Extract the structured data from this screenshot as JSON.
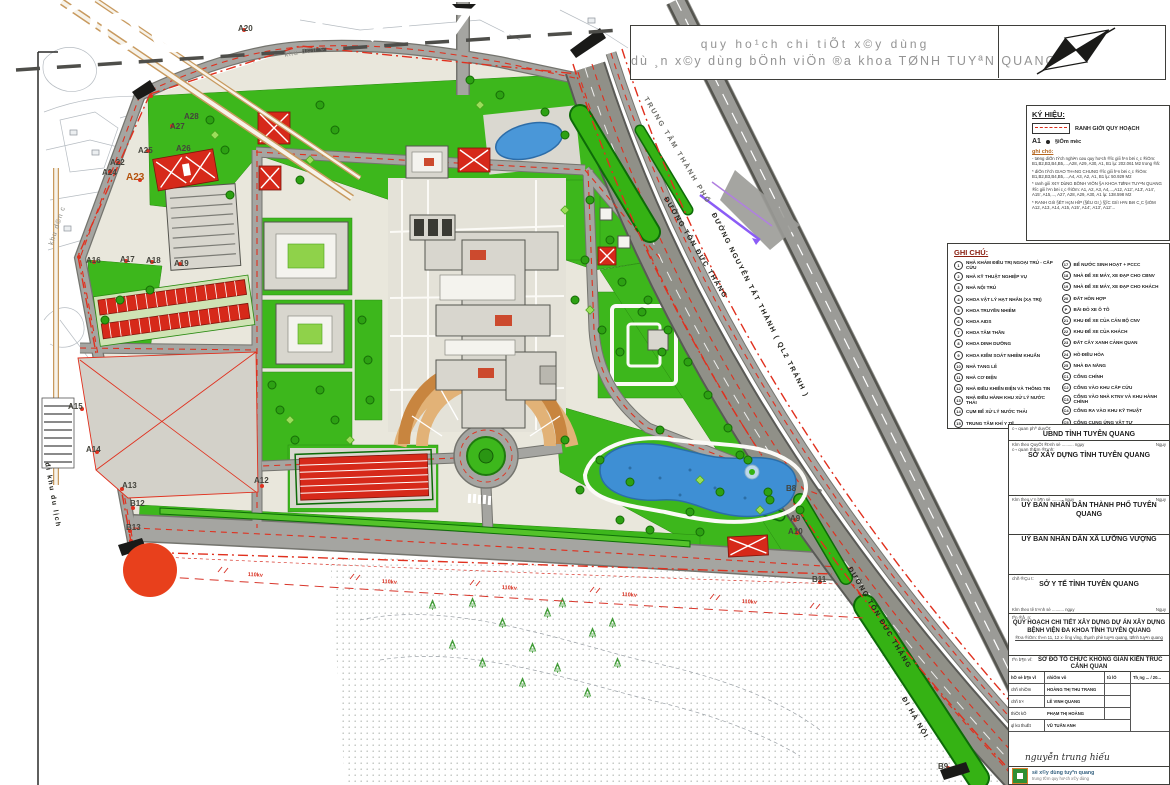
{
  "banner": {
    "line1": "quy ho¹ch chi tiÕt x©y dùng",
    "line2": "dù ¸n x©y dùng bÖnh viÖn ®a khoa TØNH TUYªN QUANG"
  },
  "legend": {
    "title": "KÝ HIỆU:",
    "boundary_label": "RANH GIỚI QUY HOẠCH",
    "marker_code": "A1",
    "marker_label": "§iÓm mèc",
    "notes_title": "ghi chó:",
    "notes": [
      "- tæng diÖn tÝch nghiªn cøu quy ho¹ch ®­îc giíi h¹n bëi c¸c ®iÓm: B1,B2,B3,B4,B5,...,A28, A29, A30, A1, B1 lµ: 202.061 M2 trong ®ã:",
      "* diÖn tÝch GIAO TH«NG CHUNG ®­îc giíi h¹n bëi c¸c ®iÓm: B1,B2,B3,B4,B5,...,A4, A3, A2, A1, B1 lµ: 50.929 M2",
      "* ranh giíi X¢Y DùNG BÖNH VIÖN §A KHOA TØNH TUYªN QUANG ®­îc giíi h¹n bëi c¸c ®iÓm: A1, A2, A3, A4,...,A12, A12', A13', A14', A15', A15,..., A27, A28, A29, A30, A1 lµ: 138.598 M2",
      "* RANH GIíI §ÊT HçN HîP (§ÊU GI¸) §¦îC GIíI H¹N BëI C¸C §IÓM A12, A13, A14, A15, A15', A14', A13', A12'..."
    ]
  },
  "notes_panel": {
    "title": "GHI CHÚ:",
    "items_left": [
      {
        "n": "1",
        "t": "NHÀ KHÁM ĐIỀU TRỊ NGOẠI TRÚ - CẤP CỨU"
      },
      {
        "n": "2",
        "t": "NHÀ KỸ THUẬT NGHIỆP VỤ"
      },
      {
        "n": "3",
        "t": "NHÀ NỘI TRÚ"
      },
      {
        "n": "4",
        "t": "KHOA VẬT LÝ HẠT NHÂN (XẠ TRỊ)"
      },
      {
        "n": "5",
        "t": "KHOA TRUYỀN NHIỄM"
      },
      {
        "n": "6",
        "t": "KHOA AIDS"
      },
      {
        "n": "7",
        "t": "KHOA TÂM THẦN"
      },
      {
        "n": "8",
        "t": "KHOA DINH DƯỠNG"
      },
      {
        "n": "9",
        "t": "KHOA KIỂM SOÁT NHIỄM KHUẨN"
      },
      {
        "n": "10",
        "t": "NHÀ TANG LỄ"
      },
      {
        "n": "11",
        "t": "NHÀ CƠ ĐIỆN"
      },
      {
        "n": "12",
        "t": "NHÀ ĐIỀU KHIỂN ĐIỆN VÀ THÔNG TIN"
      },
      {
        "n": "13",
        "t": "NHÀ ĐIỀU HÀNH KHU XỬ LÝ NƯỚC THẢI"
      },
      {
        "n": "14",
        "t": "CỤM BỂ XỬ LÝ NƯỚC THẢI"
      },
      {
        "n": "15",
        "t": "TRUNG TÂM KHÍ Y TẾ"
      },
      {
        "n": "16",
        "t": "NHÀ XỬ LÝ RÁC THẢI Y TẾ"
      }
    ],
    "items_right": [
      {
        "n": "17",
        "t": "BỂ NƯỚC SINH HOẠT + PCCC"
      },
      {
        "n": "18",
        "t": "NHÀ ĐỂ XE MÁY, XE ĐẠP CHO CBNV"
      },
      {
        "n": "19",
        "t": "NHÀ ĐỂ XE MÁY, XE ĐẠP CHO KHÁCH"
      },
      {
        "n": "20",
        "t": "ĐẤT HỖN HỢP"
      },
      {
        "n": "P",
        "t": "BÃI ĐỖ XE Ô TÔ"
      },
      {
        "n": "21",
        "t": "KHU ĐỂ XE CỦA CÁN BỘ CNV"
      },
      {
        "n": "22",
        "t": "KHU ĐỂ XE CỦA KHÁCH"
      },
      {
        "n": "23",
        "t": "ĐẤT CÂY XANH CẢNH QUAN"
      },
      {
        "n": "24",
        "t": "HỒ ĐIỀU HÒA"
      },
      {
        "n": "25",
        "t": "NHÀ ĐA NĂNG"
      },
      {
        "n": "C1",
        "t": "CỔNG CHÍNH"
      },
      {
        "n": "C2",
        "t": "CỔNG VÀO KHU CẤP CỨU"
      },
      {
        "n": "C3",
        "t": "CỔNG VÀO NHÀ KTNV VÀ KHU HÀNH CHÍNH"
      },
      {
        "n": "C4",
        "t": "CỔNG RA VÀO KHU KỸ THUẬT"
      },
      {
        "n": "C5",
        "t": "CỔNG CUNG ỨNG VẬT TƯ"
      },
      {
        "n": "C6",
        "t": "CỔNG THĂM KHÁM BỆNH NHÂN"
      }
    ]
  },
  "tb": {
    "approve_small": "c¬ quan phª duyÖt:",
    "approve_main": "UBND TỈNH TUYÊN QUANG",
    "agree_note": "KÌm theo QuyÕt ®Þnh sè .......... ngµy",
    "ngay": "Ngµy",
    "agree_small": "c¬ quan thÈm ®Þnh:",
    "agree_main": "SỞ XÂY DỰNG TỈNH TUYÊN QUANG",
    "city_note": "KÌm theo v¨n b¶n sè .......... ngµy",
    "city_main": "UỶ BAN NHÂN DÂN THÀNH PHỐ TUYÊN QUANG",
    "commune_main": "UỶ BAN NHÂN DÂN XÃ LƯỠNG VƯỢNG",
    "investor_small": "chñ ®Çu t­:",
    "investor_main": "SỞ Y TẾ TỈNH TUYÊN QUANG",
    "investor_note": "KÌm theo tê tr×nh sè .......... ngµy",
    "project_small": "tªn ®å ¸n:",
    "project_main": "QUY HOẠCH CHI TIẾT XÂY DỰNG DỰ ÁN XÂY DỰNG BỆNH VIỆN ĐA KHOA TỈNH TUYÊN QUANG",
    "project_location": "®Þa ®iÓm: th«n 11, 12 x· l­ìng v­îng, thµnh phè tuyªn quang, tØnh tuyªn quang",
    "drawing_small": "tªn b¶n vÏ:",
    "drawing_main": "SƠ ĐỒ TỔ CHỨC KHÔNG GIAN KIẾN TRÚC CẢNH QUAN",
    "signature": "nguyễn trung hiếu",
    "footer1": "së x©y dùng tuyªn quang",
    "footer2": "trung t©m quy ho¹ch x©y dùng"
  },
  "sig_table": {
    "headers": [
      "hÖ sè b¶n vÏ",
      "nhiÖm vô",
      "tû lÖ",
      "Th¸ng ... / 20..."
    ],
    "rows": [
      {
        "role": "chñ nhiÖm",
        "name": "HOÀNG THỊ THU TRANG"
      },
      {
        "role": "chñ tr×",
        "name": "LÊ VINH QUANG"
      },
      {
        "role": "thiÕt kÕ",
        "name": "PHẠM THỊ HOÀNG"
      },
      {
        "role": "ql kü thuËt",
        "name": "VŨ TUẤN ANH"
      }
    ]
  },
  "map": {
    "road_labels": [
      {
        "t": "TRUNG TÂM THÀNH PHỐ",
        "x": 648,
        "y": 96,
        "rot": 59,
        "cls": ""
      },
      {
        "t": "ĐƯỜNG TÔN ĐỨC THẮNG",
        "x": 668,
        "y": 196,
        "rot": 59,
        "cls": "dark"
      },
      {
        "t": "ĐƯỜNG NGUYỄN TẤT THÀNH ( QL2 TRÁNH )",
        "x": 716,
        "y": 212,
        "rot": 63,
        "cls": "dark"
      },
      {
        "t": "ĐƯỜNG TÔN ĐỨC THẮNG",
        "x": 852,
        "y": 566,
        "rot": 59,
        "cls": "dark"
      },
      {
        "t": "ĐI HÀ NỘI",
        "x": 906,
        "y": 696,
        "rot": 60,
        "cls": "dark"
      },
      {
        "t": "đi khu du lịch",
        "x": 50,
        "y": 462,
        "rot": 80,
        "cls": "dark"
      }
    ],
    "point_labels": [
      {
        "t": "A20",
        "x": 238,
        "y": 24
      },
      {
        "t": "A28",
        "x": 184,
        "y": 112
      },
      {
        "t": "A27",
        "x": 170,
        "y": 122
      },
      {
        "t": "A26",
        "x": 176,
        "y": 144
      },
      {
        "t": "A25",
        "x": 138,
        "y": 146
      },
      {
        "t": "A22",
        "x": 110,
        "y": 158
      },
      {
        "t": "A24",
        "x": 102,
        "y": 168
      },
      {
        "t": "A23",
        "x": 126,
        "y": 172,
        "cls": "hl"
      },
      {
        "t": "A16",
        "x": 86,
        "y": 256
      },
      {
        "t": "A17",
        "x": 120,
        "y": 255
      },
      {
        "t": "A18",
        "x": 146,
        "y": 256
      },
      {
        "t": "A19",
        "x": 174,
        "y": 259
      },
      {
        "t": "A15",
        "x": 68,
        "y": 402
      },
      {
        "t": "A14",
        "x": 86,
        "y": 445
      },
      {
        "t": "A13",
        "x": 122,
        "y": 481
      },
      {
        "t": "B12",
        "x": 130,
        "y": 499
      },
      {
        "t": "B13",
        "x": 126,
        "y": 523
      },
      {
        "t": "A12",
        "x": 254,
        "y": 476
      },
      {
        "t": "B8",
        "x": 786,
        "y": 484
      },
      {
        "t": "A9",
        "x": 790,
        "y": 514
      },
      {
        "t": "A10",
        "x": 788,
        "y": 527
      },
      {
        "t": "B11",
        "x": 812,
        "y": 575
      },
      {
        "t": "B9",
        "x": 938,
        "y": 762
      }
    ],
    "area_labels": [
      {
        "t": "khu d©n c­",
        "x": 48,
        "y": 244,
        "rot": -72
      },
      {
        "t": "khu d©n c­",
        "x": 284,
        "y": 52,
        "rot": -10
      }
    ],
    "power_labels": [
      {
        "t": "110kv",
        "x": 248,
        "y": 572,
        "rot": 3
      },
      {
        "t": "110kv",
        "x": 382,
        "y": 579,
        "rot": 3
      },
      {
        "t": "110kv",
        "x": 502,
        "y": 585,
        "rot": 3
      },
      {
        "t": "110kv",
        "x": 622,
        "y": 592,
        "rot": 3
      },
      {
        "t": "110kv",
        "x": 742,
        "y": 599,
        "rot": 3
      }
    ]
  },
  "colors": {
    "green": "#3db71c",
    "tree": "#2da113",
    "road": "#a5a5a1",
    "red_building": "#d6291a",
    "pond_blue": "#4a97d8",
    "boundary_red": "#e0301e",
    "plaza_tan": "#e2b277",
    "annotation_dot": "#e8401c"
  }
}
